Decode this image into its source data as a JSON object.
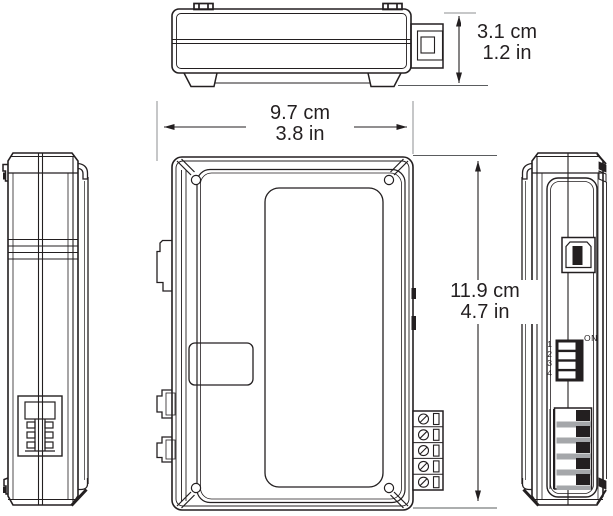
{
  "dimensions": {
    "depth": {
      "metric": "3.1 cm",
      "imperial": "1.2 in"
    },
    "width": {
      "metric": "9.7 cm",
      "imperial": "3.8 in"
    },
    "height": {
      "metric": "11.9 cm",
      "imperial": "4.7 in"
    }
  },
  "dip_switch": {
    "on_label": "ON",
    "positions": [
      "1",
      "2",
      "3",
      "4"
    ]
  },
  "colors": {
    "line": "#231f20",
    "background": "#ffffff",
    "extension_line_gray": "#8d8f92",
    "terminal_gray": "#a5a7aa"
  }
}
